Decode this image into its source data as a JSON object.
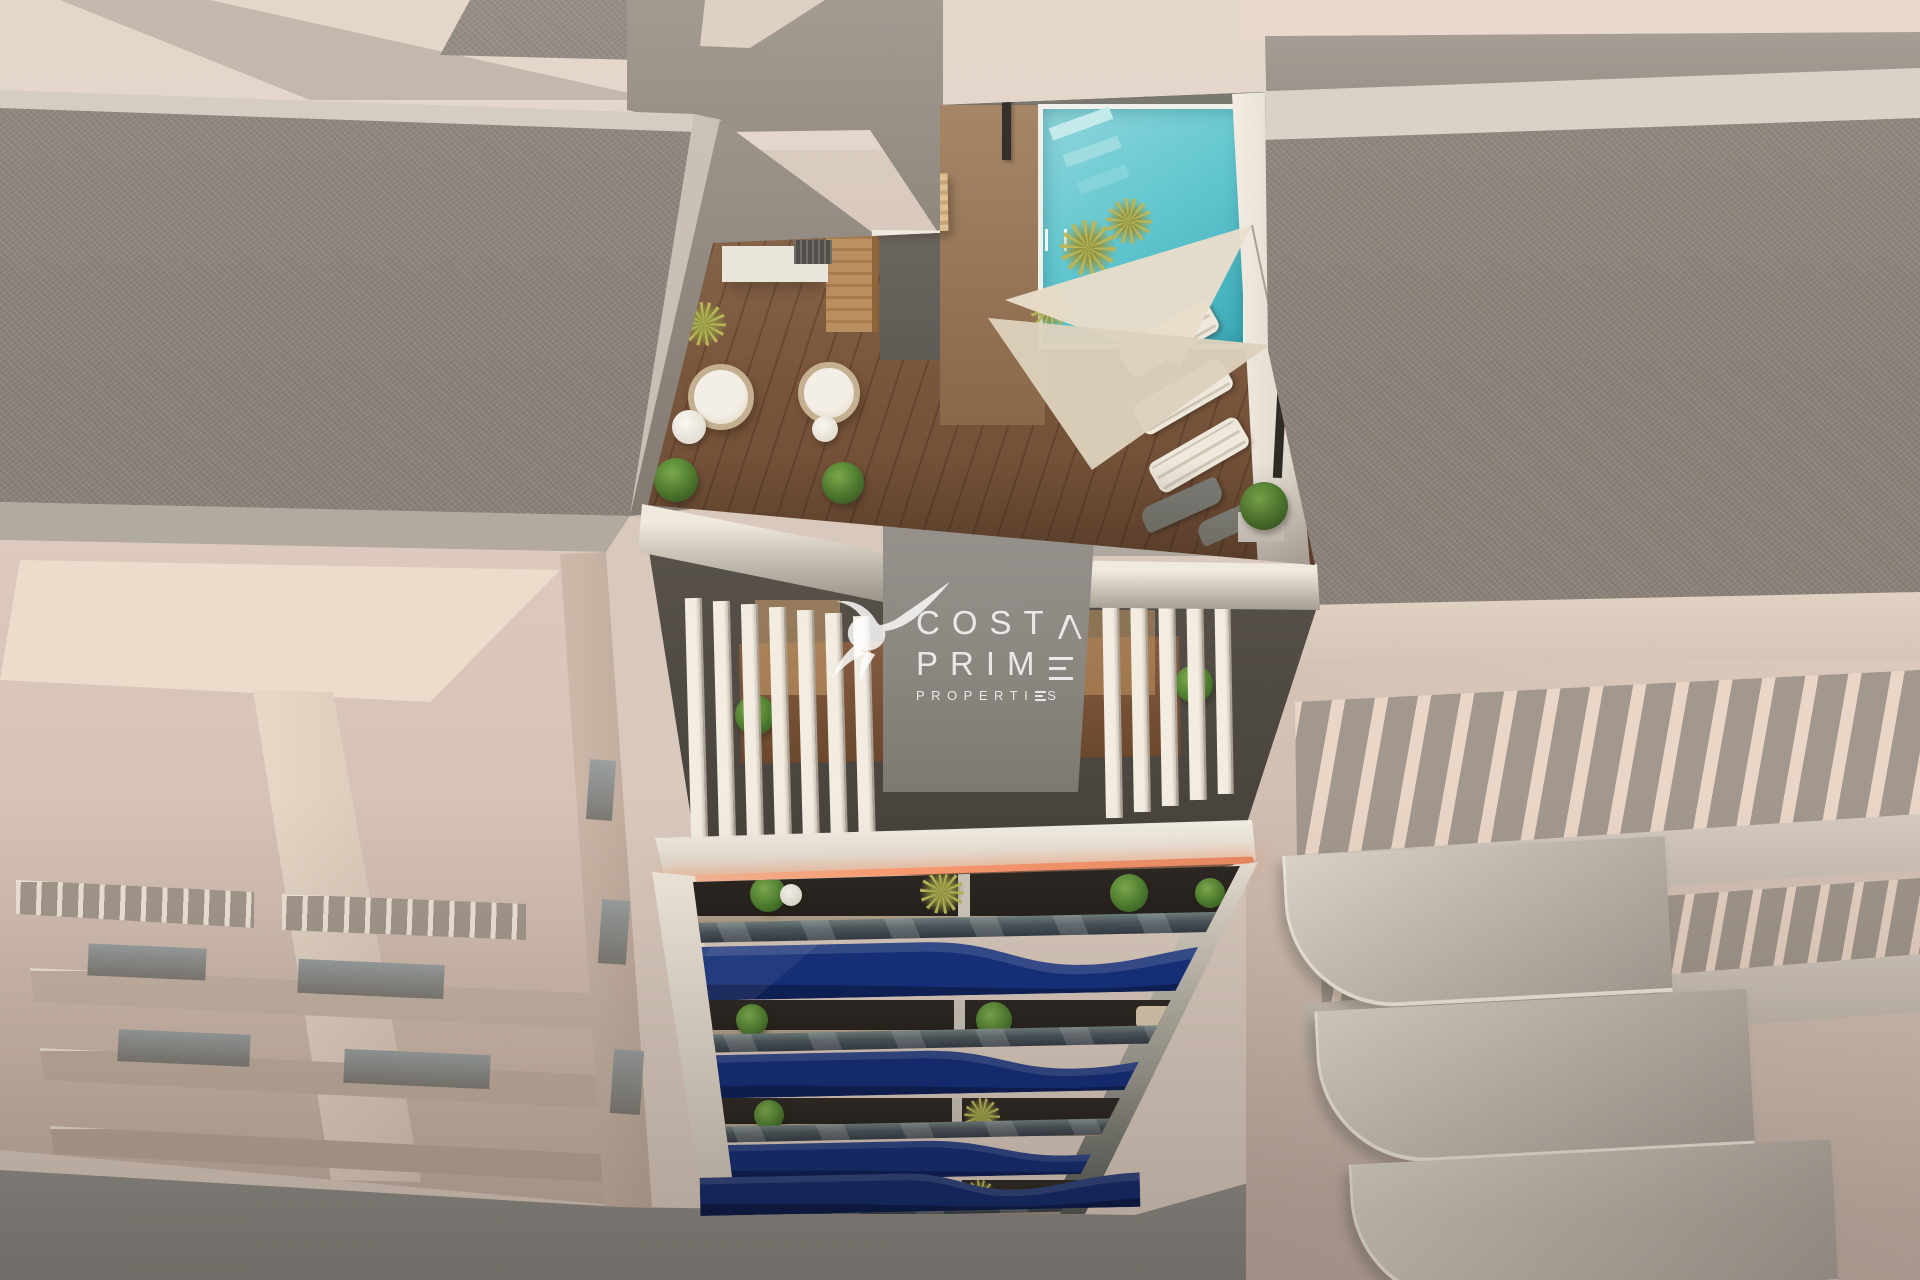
{
  "watermark": {
    "logo_icon": "hummingbird-icon",
    "line1": "COSTA",
    "line1_head": "COST",
    "line2": "PRIME",
    "line2_head": "PRIM",
    "line3": "PROPERTIES",
    "line3_head": "PROPERTI",
    "line3_tail": "S",
    "color": "#ffffff"
  },
  "scene": {
    "type": "aerial-architectural-render",
    "colors": {
      "balcony_blue": "#14307e",
      "pool_turquoise": "#5fc6cf",
      "led_strip": "#ff9d72",
      "wood_deck": "#8a684e",
      "gravel_gray": "#89817a",
      "sand_beige": "#dccabd",
      "white_trim": "#f0e9de",
      "pavement_gray": "#8f8d88"
    }
  }
}
